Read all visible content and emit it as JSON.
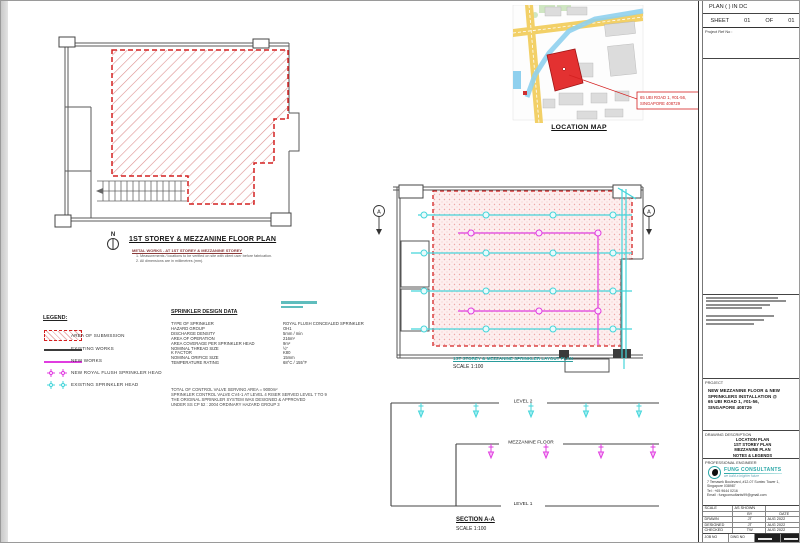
{
  "colors": {
    "red": "#d42020",
    "magenta": "#e03ce0",
    "cyan": "#45d5da",
    "teal": "#2aa7a7"
  },
  "location_map": {
    "title": "LOCATION MAP",
    "callout": [
      "65 UBI ROAD 1, #01-56,",
      "SINGAPORE 408729"
    ]
  },
  "left_plan": {
    "north": "N",
    "title": "1ST STOREY & MEZZANINE FLOOR PLAN",
    "subtitle": "METAL WORKS - AT 1ST STOREY & MEZZANINE STOREY",
    "note1": "1.  Measurements / locations to be verified on site with client user before fabrication.",
    "note2": "2.  All dimensions are in millimetres (mm)."
  },
  "legend": {
    "title": "LEGEND:",
    "items": [
      "AREA OF SUBMISSION",
      "EXISTING WORKS",
      "NEW WORKS",
      "NEW ROYAL FLUSH SPRINKLER HEAD",
      "EXISTING SPRINKLER HEAD"
    ]
  },
  "sprinkler_data": {
    "title": "SPRINKLER DESIGN DATA",
    "rows": [
      {
        "label": "TYPE OF SPRINKLER",
        "value": "ROYAL FLUSH CONCEALED SPRINKLER"
      },
      {
        "label": "HAZARD GROUP",
        "value": "OH1"
      },
      {
        "label": "DISCHARGE DENSITY",
        "value": "5mm / min"
      },
      {
        "label": "AREA OF OPERATION",
        "value": "216m²"
      },
      {
        "label": "AREA COVERAGE PER SPRINKLER HEAD",
        "value": "9m²"
      },
      {
        "label": "NOMINAL THREAD SIZE",
        "value": "½\""
      },
      {
        "label": "K FACTOR",
        "value": "K80"
      },
      {
        "label": "NOMINAL ORIFICE SIZE",
        "value": "15mm"
      },
      {
        "label": "TEMPERATURE RATING",
        "value": "68°C / 155°F"
      }
    ],
    "notes": [
      "TOTAL OF CONTROL VALVE SERVING AREA = 9000m²",
      "SPRINKLER CONTROL VALVE CV4-1 AT LEVEL 4 RISER  SERVED LEVEL 7 TO 9",
      "THE ORIGINAL SPRINKLER SYSTEM WAS DESIGNED & APPROVED",
      "UNDER SS CP 52 : 2004 ORDINARY HAZARD GROUP 3"
    ]
  },
  "right_plan": {
    "title": "1ST STOREY & MEZZANINE SPRINKLER LAYOUT PLAN",
    "scale": "SCALE   1:100",
    "marker": "A"
  },
  "section": {
    "level2": "LEVEL  2",
    "mezzanine": "MEZZANINE  FLOOR",
    "level1": "LEVEL  1",
    "title": "SECTION A-A",
    "scale": "SCALE   1:100"
  },
  "title_block": {
    "plan_label": "PLAN  (            )  IN  DC",
    "sheet": {
      "label": "SHEET",
      "num": "01",
      "of": "OF",
      "total": "01"
    },
    "project_ref": "Project Ref No :",
    "project_header": "PROJECT",
    "project_lines": [
      "NEW MEZZANINE FLOOR & NEW",
      "SPRINKLERS INSTALLATION @",
      "65 UBI ROAD 1, #01-56,",
      "SINGAPORE 408729"
    ],
    "desc_header": "DRAWING DESCRIPTION",
    "desc_lines": [
      "LOCATION PLAN",
      "1ST STOREY PLAN",
      "MEZZANINE PLAN",
      "NOTES & LEGENDS"
    ],
    "engineer_header": "PROFESSIONAL ENGINEER",
    "consultant": {
      "name": "FUNG CONSULTANTS",
      "tagline": "we build a brighter future",
      "addr1": "7 Temasek Boulevard, #12-07 Suntec Tower 1,",
      "addr2": "Singapore 038987",
      "tel": "Tel : +65 9644 0216",
      "email": "Email : fungconsultants99@gmail.com"
    },
    "signoff": {
      "scale_label": "SCALE",
      "scale_value": "AS SHOWN",
      "by": "BY",
      "date": "DATE",
      "rows": [
        {
          "label": "DRAWN",
          "by": "JT",
          "date": "AUG 2022"
        },
        {
          "label": "DESIGNED",
          "by": "JT",
          "date": "AUG 2022"
        },
        {
          "label": "CHECKED",
          "by": "TW",
          "date": "AUG 2022"
        },
        {
          "label": "APPROVED",
          "by": "TW",
          "date": "AUG 2022"
        }
      ]
    },
    "job_no": "JOB NO",
    "dwg_no": "DWG NO"
  }
}
